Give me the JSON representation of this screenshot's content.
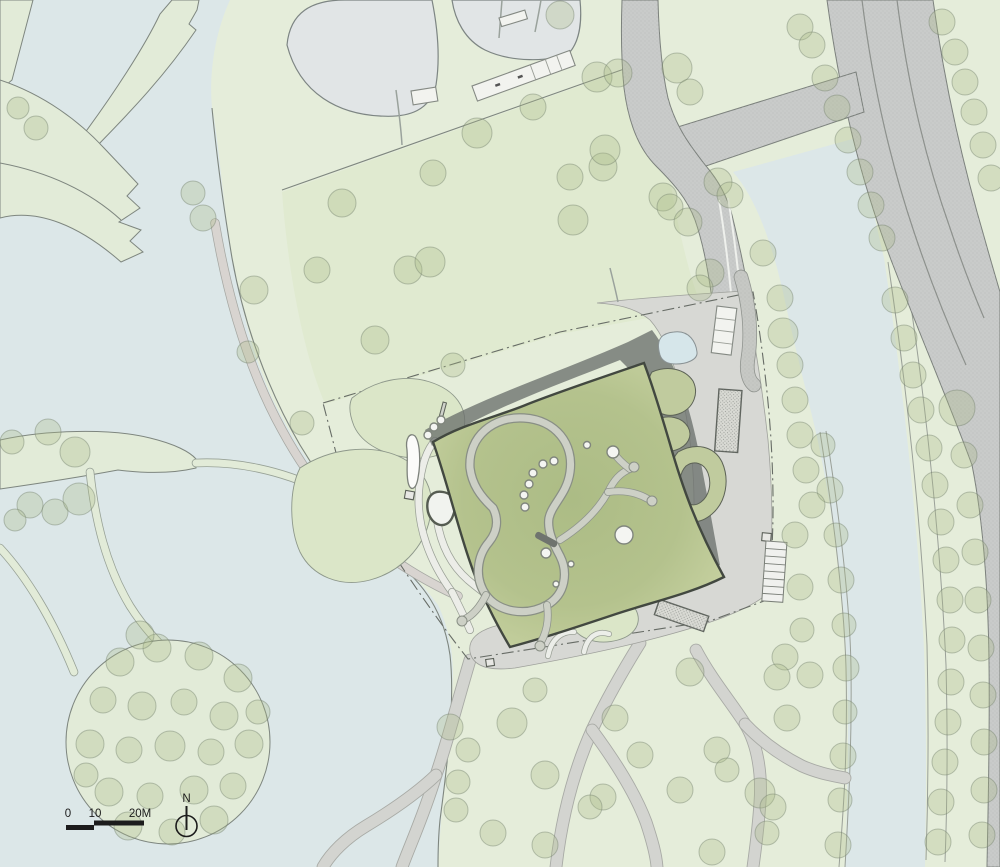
{
  "colors": {
    "water": "#dce7e8",
    "park_green": "#e5edda",
    "meadow_green": "#e0ead0",
    "causeway_green": "#e2ebd8",
    "roof_outline": "#424840",
    "shadow_gray": "#6b716d",
    "road_gray": "#c9cbca",
    "plaza_gray": "#d7d8d4",
    "path_gray": "#d3d4d0",
    "path_edge": "#a8aaa5",
    "pond_gray": "#e1e5e6",
    "water_pond": "#d6e6ea",
    "outline_gray": "#7e867f",
    "tree_fill": "#a9bb86",
    "tree_stroke": "#76836f",
    "ink": "#1c1c1c"
  },
  "scale_bar": {
    "labels": [
      "0",
      "10",
      "20M"
    ]
  },
  "north_arrow": {
    "label": "N"
  },
  "features": {
    "trees": [
      [
        18,
        108,
        11
      ],
      [
        36,
        128,
        12
      ],
      [
        193,
        193,
        12
      ],
      [
        203,
        218,
        13
      ],
      [
        254,
        290,
        14
      ],
      [
        317,
        270,
        13
      ],
      [
        248,
        352,
        11
      ],
      [
        302,
        423,
        12
      ],
      [
        342,
        203,
        14
      ],
      [
        408,
        270,
        14
      ],
      [
        430,
        262,
        15
      ],
      [
        375,
        340,
        14
      ],
      [
        453,
        365,
        12
      ],
      [
        433,
        173,
        13
      ],
      [
        477,
        133,
        15
      ],
      [
        533,
        107,
        13
      ],
      [
        570,
        177,
        13
      ],
      [
        597,
        77,
        15
      ],
      [
        560,
        15,
        14
      ],
      [
        573,
        220,
        15
      ],
      [
        603,
        167,
        14
      ],
      [
        605,
        150,
        15
      ],
      [
        618,
        73,
        14
      ],
      [
        677,
        68,
        15
      ],
      [
        690,
        92,
        13
      ],
      [
        663,
        197,
        14
      ],
      [
        670,
        207,
        13
      ],
      [
        688,
        222,
        14
      ],
      [
        710,
        273,
        14
      ],
      [
        700,
        288,
        13
      ],
      [
        718,
        182,
        14
      ],
      [
        730,
        195,
        13
      ],
      [
        763,
        253,
        13
      ],
      [
        800,
        27,
        13
      ],
      [
        812,
        45,
        13
      ],
      [
        825,
        78,
        13
      ],
      [
        837,
        108,
        13
      ],
      [
        848,
        140,
        13
      ],
      [
        860,
        172,
        13
      ],
      [
        871,
        205,
        13
      ],
      [
        882,
        238,
        13
      ],
      [
        942,
        22,
        13
      ],
      [
        955,
        52,
        13
      ],
      [
        965,
        82,
        13
      ],
      [
        974,
        112,
        13
      ],
      [
        983,
        145,
        13
      ],
      [
        991,
        178,
        13
      ],
      [
        895,
        300,
        13
      ],
      [
        904,
        338,
        13
      ],
      [
        913,
        375,
        13
      ],
      [
        921,
        410,
        13
      ],
      [
        929,
        448,
        13
      ],
      [
        935,
        485,
        13
      ],
      [
        941,
        522,
        13
      ],
      [
        946,
        560,
        13
      ],
      [
        950,
        600,
        13
      ],
      [
        952,
        640,
        13
      ],
      [
        951,
        682,
        13
      ],
      [
        948,
        722,
        13
      ],
      [
        945,
        762,
        13
      ],
      [
        941,
        802,
        13
      ],
      [
        938,
        842,
        13
      ],
      [
        957,
        408,
        18
      ],
      [
        964,
        455,
        13
      ],
      [
        970,
        505,
        13
      ],
      [
        975,
        552,
        13
      ],
      [
        978,
        600,
        13
      ],
      [
        981,
        648,
        13
      ],
      [
        983,
        695,
        13
      ],
      [
        984,
        742,
        13
      ],
      [
        984,
        790,
        13
      ],
      [
        982,
        835,
        13
      ],
      [
        823,
        445,
        12
      ],
      [
        830,
        490,
        13
      ],
      [
        836,
        535,
        12
      ],
      [
        841,
        580,
        13
      ],
      [
        844,
        625,
        12
      ],
      [
        846,
        668,
        13
      ],
      [
        845,
        712,
        12
      ],
      [
        843,
        756,
        13
      ],
      [
        840,
        800,
        12
      ],
      [
        838,
        845,
        13
      ],
      [
        780,
        298,
        13
      ],
      [
        783,
        333,
        15
      ],
      [
        790,
        365,
        13
      ],
      [
        795,
        400,
        13
      ],
      [
        800,
        435,
        13
      ],
      [
        806,
        470,
        13
      ],
      [
        812,
        505,
        13
      ],
      [
        795,
        535,
        13
      ],
      [
        800,
        587,
        13
      ],
      [
        802,
        630,
        12
      ],
      [
        785,
        657,
        13
      ],
      [
        810,
        675,
        13
      ],
      [
        690,
        672,
        14
      ],
      [
        777,
        677,
        13
      ],
      [
        615,
        718,
        13
      ],
      [
        717,
        750,
        13
      ],
      [
        727,
        770,
        12
      ],
      [
        787,
        718,
        13
      ],
      [
        760,
        793,
        15
      ],
      [
        773,
        807,
        13
      ],
      [
        767,
        833,
        12
      ],
      [
        712,
        852,
        13
      ],
      [
        603,
        797,
        13
      ],
      [
        590,
        807,
        12
      ],
      [
        512,
        723,
        15
      ],
      [
        545,
        775,
        14
      ],
      [
        493,
        833,
        13
      ],
      [
        450,
        727,
        13
      ],
      [
        468,
        750,
        12
      ],
      [
        458,
        782,
        12
      ],
      [
        456,
        810,
        12
      ],
      [
        535,
        690,
        12
      ],
      [
        640,
        755,
        13
      ],
      [
        680,
        790,
        13
      ],
      [
        545,
        845,
        13
      ],
      [
        120,
        662,
        14
      ],
      [
        157,
        648,
        14
      ],
      [
        199,
        656,
        14
      ],
      [
        238,
        678,
        14
      ],
      [
        103,
        700,
        13
      ],
      [
        142,
        706,
        14
      ],
      [
        184,
        702,
        13
      ],
      [
        224,
        716,
        14
      ],
      [
        90,
        744,
        14
      ],
      [
        129,
        750,
        13
      ],
      [
        170,
        746,
        15
      ],
      [
        211,
        752,
        13
      ],
      [
        249,
        744,
        14
      ],
      [
        109,
        792,
        14
      ],
      [
        150,
        796,
        13
      ],
      [
        194,
        790,
        14
      ],
      [
        233,
        786,
        13
      ],
      [
        128,
        826,
        14
      ],
      [
        172,
        832,
        13
      ],
      [
        214,
        820,
        14
      ],
      [
        258,
        712,
        12
      ],
      [
        86,
        775,
        12
      ],
      [
        140,
        635,
        14
      ],
      [
        48,
        432,
        13
      ],
      [
        12,
        442,
        12
      ],
      [
        75,
        452,
        15
      ],
      [
        30,
        505,
        13
      ],
      [
        55,
        512,
        13
      ],
      [
        79,
        499,
        16
      ],
      [
        15,
        520,
        11
      ]
    ],
    "skylights": [
      [
        554,
        461,
        4
      ],
      [
        543,
        464,
        4
      ],
      [
        533,
        473,
        4
      ],
      [
        529,
        484,
        4
      ],
      [
        524,
        495,
        4
      ],
      [
        525,
        507,
        4
      ],
      [
        546,
        553,
        5
      ],
      [
        571,
        564,
        3
      ],
      [
        556,
        584,
        3
      ],
      [
        428,
        435,
        4
      ],
      [
        434,
        427,
        4
      ],
      [
        441,
        420,
        4
      ]
    ],
    "roof_big_circle": {
      "x": 624,
      "y": 535,
      "r": 9
    },
    "roof_ring_circle": {
      "x": 613,
      "y": 452,
      "r": 6
    },
    "roof_small_circle": {
      "x": 587,
      "y": 445,
      "r": 3.5
    },
    "branch_bulbs": [
      [
        634,
        467,
        5
      ],
      [
        652,
        501,
        5
      ],
      [
        540,
        646,
        5
      ],
      [
        462,
        621,
        5
      ]
    ],
    "parking": {
      "x": 766,
      "y": 541,
      "w": 21,
      "h": 60,
      "stalls": 8,
      "angle": 4
    }
  }
}
